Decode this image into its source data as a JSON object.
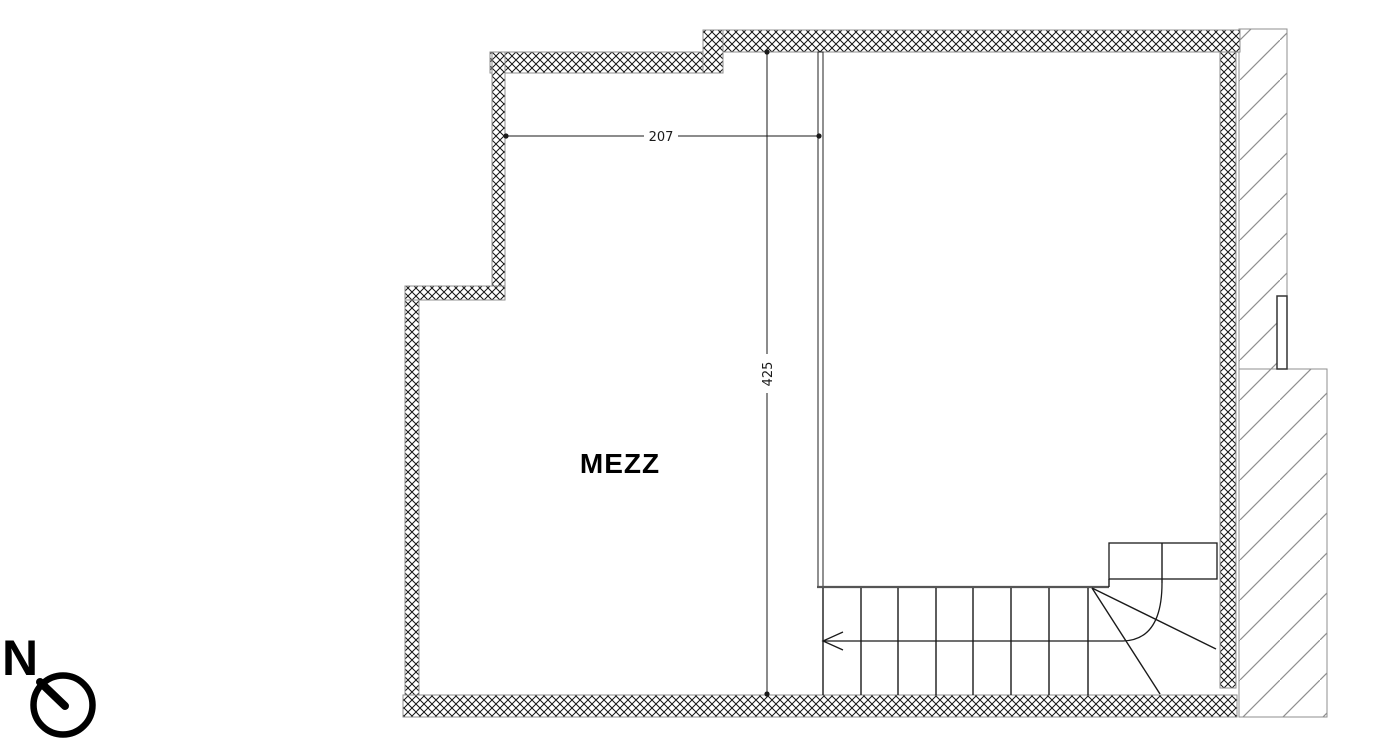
{
  "page": {
    "background_color": "#ffffff"
  },
  "floorplan": {
    "room_label": "MEZZ",
    "dimensions": {
      "width": "207",
      "depth": "425"
    },
    "north": {
      "label": "N"
    }
  },
  "colors": {
    "line": "#1a1a1a",
    "wall_outline": "#8f8f8f",
    "neighbor_hatch": "#8f8f8f",
    "wall_hatch": "#141414"
  },
  "icons": {
    "north_indicator": "north-arrow-circle"
  }
}
